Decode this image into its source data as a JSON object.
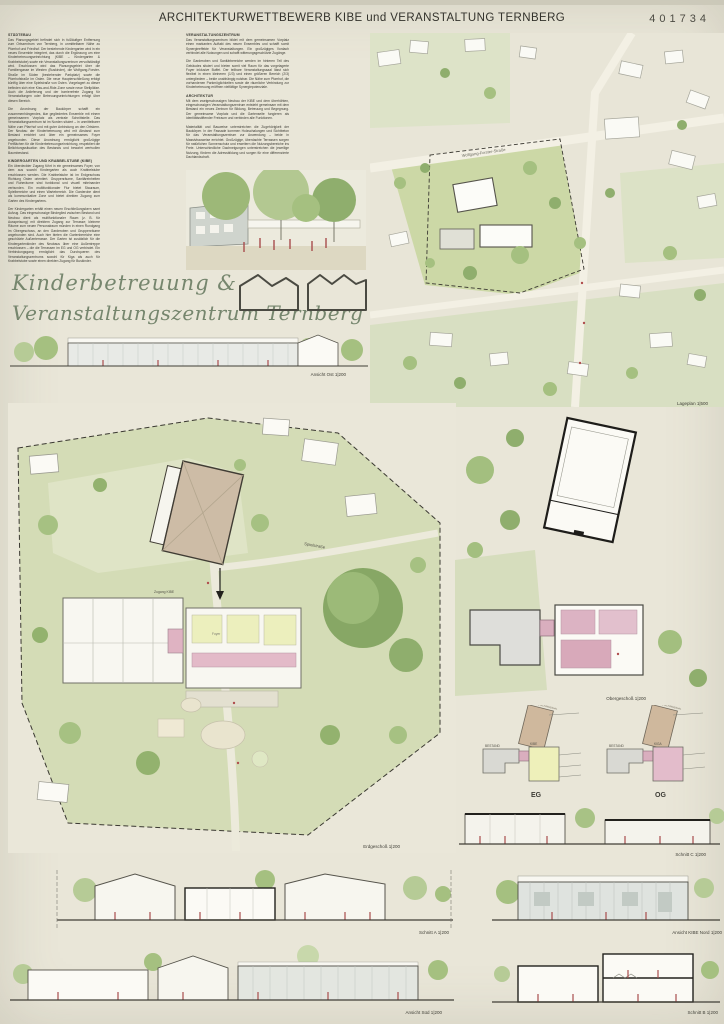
{
  "header": {
    "title": "ARCHITEKTURWETTBEWERB KIBE und VERANSTALTUNG TERNBERG",
    "project_number": "401734"
  },
  "columns": {
    "staedtebau": {
      "heading": "STÄDTEBAU",
      "p1": "Das Planungsgebiet befindet sich in fußläufiger Entfernung zum Ortszentrum von Ternberg, in unmittelbarer Nähe zu Pfarrhof und Friedhof. Der bestehende Kindergarten wird in ein neues Ensemble integriert, das durch die Ergänzung um eine Kinderbetreuungseinrichtung (KIBE – Kindergarten & Krabbelstube) sowie ein Veranstaltungszentrum vervollständigt wird. Erschlossen wird das Planungsgebiet über die Familiengasse im Westen (Buskinder), die Wolfgang-Forster-Straße im Süden (bestehender Parkplatz) sowie die Pfarrhofstraße im Osten. Die neue Haupterschließung erfolgt künftig über eine Spielstraße von Osten. Vorgelagert zu dieser befinden sich eine Kiss-and-Ride-Zone sowie neue Stellplätze. Auch die Anlieferung und der barrierefreie Zugang für Veranstaltungen oder Betreuungseinrichtungen erfolgt über diesen Bereich.",
      "p2": "Die Anordnung der Baukörper schafft ein zusammenhängendes, klar gegliedertes Ensemble mit einem gemeinsamen Vorplatz als zentrale Schnittstelle. Das Veranstaltungszentrum ist im Norden situiert – in unmittelbarer Nähe zum Pfarrhof und mit guter Anbindung an den Ortskern. Der Neubau der Kinderbetreuung wird mit Abstand zum Bestand errichtet und über ein gemeinsames Foyer angebunden. Diese Anordnung ermöglicht großzügige Freiflächen für die Kinderbetreuungseinrichtung, respektiert die Belichtungssituation des Bestands und bewahrt wertvollen Baumbestand."
    },
    "kibe": {
      "heading": "KINDERGARTEN UND KRABBELSTUBE (KIBE)",
      "p1": "Ein überdeckter Zugang führt in ein gemeinsames Foyer, von dem aus sowohl Kindergarten als auch Krabbelstube erschlossen werden. Die Krabbelstube ist im Erdgeschoss Richtung Osten orientiert. Gruppenräume, Sanitäreinheiten und Ruheräume sind funktional und visuell miteinander verbunden. Ein multifunktionaler Flur bietet Stauraum, Spielbereiche und einen Wartebereich. Die Garderobe dient als kommunikative Zone und bietet direkten Zugang zum Garten des Kindergartens.",
      "p2": "Der Kindergarten erhält einen neuen Erschließungskern samt Aufzug. Das eingeschossige Bindeglied zwischen Bestand und Neubau dient als multifunktionaler Raum (z. B. für Ausspeisung) mit direktem Zugang zur Terrasse; kleinere Räume zum neuen Personalraum münden in einen Rundgang im Obergeschoss, an den Garderoben und Gruppenräume angebunden sind. Auch hier bieten die Gartenbereiche eine geschützte Außenterrasse. Der Garten ist zusätzlich für die Kindergartenkinder des Neubaus über eine Außentreppe erschlossen – die die Terrassen im EG und OG verbindet. Ein Verbindungsgang ermöglicht das Durchqueren des Veranstaltungszentrums sowohl für Kiga als auch für Krabbelstube sowie einen direkten Zugang für Buskinder."
    },
    "veranstaltung": {
      "heading": "VERANSTALTUNGSZENTRUM",
      "p1": "Das Veranstaltungszentrum bildet mit dem gemeinsamen Vorplatz einen markanten Auftakt des neuen Ensembles und schafft somit Synergieeffekte für Veranstaltungen. Ein großzügiges Vordach verbindet alle Nutzungen und schafft witterungsgeschützte Zugänge.",
      "p2": "Die Garderoben und Sanitärbereiche werden im hinteren Teil des Gebäudes situiert und bieten somit viel Raum für das vorgelagerte Foyer inklusive Buffet. Der teilbare Veranstaltungssaal lässt sich flexibel in einen kleineren (1/3) und einen größeren Bereich (2/3) untergliedern – beide unabhängig nutzbar. Die Nähe zum Pfarrhof, die vorhandenen Parkmöglichkeiten sowie die räumliche Verbindung zur Kinderbetreuung eröffnen vielfältige Synergiepotenziale."
    },
    "architektur": {
      "heading": "ARCHITEKTUR",
      "p1": "Mit dem zweigeschossigen Neubau der KIBE und dem überhöhten, eingeschossigen Veranstaltungszentrum entsteht gemeinsam mit dem Bestand ein neues Zentrum für Bildung, Betreuung und Begegnung. Der gemeinsame Vorplatz und die Gartenseite fungieren als identitätsstiftender Freiraum und verbinden alle Funktionen.",
      "p2": "Materialität und Bauweise unterstreichen die Zugehörigkeit der Baukörper. In der Fassade kommen Holzschalungen und Sichtbeton für das Veranstaltungszentrum zur Anwendung – beide in Massivbauweise errichtet. Großzügige, überdachte Terrassen sorgen für natürlichen Sonnenschutz und erweitern die Nutzungsbereiche ins Freie. Unterschiedliche Dachneigungen unterstreichen die jeweilige Nutzung, fördern die Adressbildung und sorgen für eine differenzierte Dachlandschaft."
    }
  },
  "title_block": {
    "line1": "Kinderbetreuung &",
    "line2": "Veranstaltungszentrum Ternberg"
  },
  "drawings": {
    "ansicht_ost": "Ansicht Ost 1|200",
    "lageplan": "Lageplan 1|500",
    "erdgeschoss": "Erdgeschoß 1|200",
    "obergeschoss": "Obergeschoß 1|200",
    "schnitt_c": "Schnitt C 1|200",
    "schnitt_a": "Schnitt A 1|200",
    "ansicht_kibe_nord": "Ansicht KIBE Nord 1|200",
    "ansicht_sued": "Ansicht Süd 1|200",
    "schnitt_b": "Schnitt B 1|200"
  },
  "plan_annotations": {
    "street": "Wolfgang-Forster-Straße",
    "spielstrasse": "Spielstraße",
    "zugang_kibe": "Zugang KIBE",
    "foyer": "Foyer"
  },
  "schema": {
    "eg_label": "EG",
    "og_label": "OG",
    "bestand": "BESTAND",
    "kibe": "KIBE",
    "kiga": "KIGA",
    "saal": "VERANSTALTUNGSSAAL"
  },
  "colors": {
    "paper": "#e9e6d8",
    "site_green": "#ccd8a6",
    "tree_green": "#a5c080",
    "dark_tree": "#8fae6d",
    "hall_tan": "#cdbca6",
    "room_yellow": "#ecefbd",
    "room_pink": "#e0b4c4",
    "figure_red": "#a84c4c",
    "title_green": "#76866e",
    "ink": "#3c3b34"
  }
}
